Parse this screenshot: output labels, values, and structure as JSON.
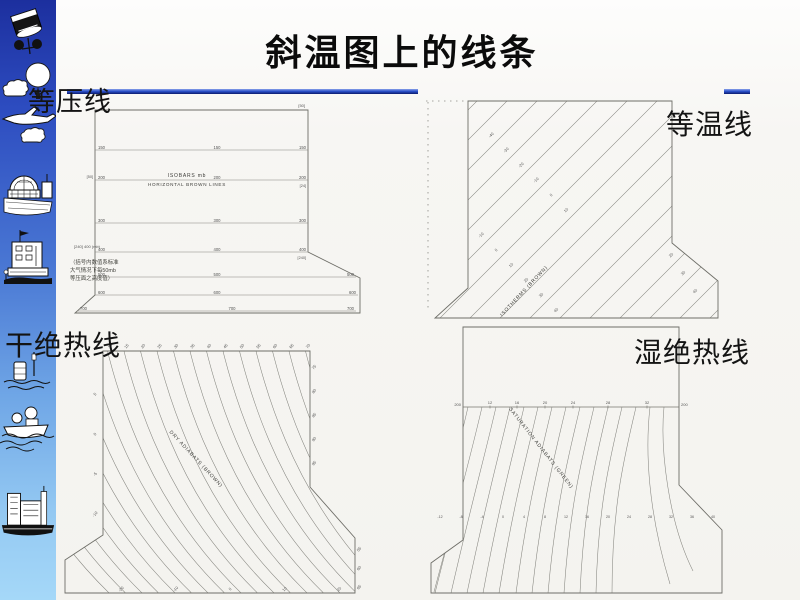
{
  "slide": {
    "title": "斜温图上的线条",
    "panel_labels": {
      "isobars": "等压线",
      "isotherms": "等温线",
      "dry_adiabats": "干绝热线",
      "moist_adiabats": "湿绝热线"
    }
  },
  "colors": {
    "accent_blue": "#2c52cc",
    "rule_dark": "#0b1b6e",
    "sidebar_top": "#1c2f9e",
    "sidebar_bottom": "#a5d8f8",
    "scan_line": "#84847e",
    "paper": "#f4f3ef"
  },
  "sidebar": {
    "icons": [
      "satellite-icon",
      "balloon-cloud-icon",
      "airplane-icon",
      "cloud-icon",
      "radar-station-icon",
      "observatory-icon",
      "buoy-icon",
      "ship-icon",
      "harbor-icon"
    ]
  },
  "diagrams": {
    "isobars": {
      "type": "line",
      "inner_title_1": "ISOBARS  mb",
      "inner_title_2": "HORIZONTAL  BROWN  LINES",
      "pressure_levels": [
        "150",
        "200",
        "300",
        "400",
        "500",
        "600",
        "700"
      ],
      "bracket_top_right": "[50]",
      "bracket_left_200": "[50]",
      "bracket_right_200": "[24]",
      "bracket_right_400": "[240]",
      "note_400": "[240] 400 (mb)",
      "annotation_cn": [
        "（括号内数值系标准",
        "大气情况下每50mb",
        "等压面之高度值）"
      ]
    },
    "isotherms": {
      "type": "line",
      "inner_label": "ISOTHERMS (BROWN)",
      "values_band_a": [
        "-40",
        "-30",
        "-20",
        "-10",
        "0",
        "10"
      ],
      "values_band_b": [
        "-10",
        "0",
        "10",
        "20",
        "30",
        "40"
      ],
      "values_band_c": [
        "20",
        "30",
        "40"
      ]
    },
    "dry_adiabats": {
      "type": "line",
      "inner_label": "DRY ADIABATS (BROWN)",
      "top_values": [
        "10",
        "15",
        "20",
        "25",
        "30",
        "35",
        "40",
        "45",
        "50",
        "55",
        "60",
        "65",
        "70"
      ],
      "left_values": [
        "5",
        "0",
        "-5",
        "-10"
      ],
      "right_values": [
        "75",
        "80",
        "85",
        "90",
        "95"
      ],
      "bottom_values": [
        "-20",
        "-10",
        "0",
        "10",
        "20"
      ],
      "flare_values": [
        "55",
        "60",
        "65"
      ]
    },
    "moist_adiabats": {
      "type": "line",
      "inner_label": "SATURATION  ADIABATS  (GREEN)",
      "level_line_left": "200",
      "level_line_right": "200",
      "level_line_values": [
        "12",
        "16",
        "20",
        "24",
        "28",
        "32"
      ],
      "lower_values": [
        "-12",
        "-8",
        "-4",
        "0",
        "4",
        "8",
        "12",
        "16",
        "20",
        "24",
        "28",
        "32",
        "36",
        "40"
      ]
    }
  }
}
